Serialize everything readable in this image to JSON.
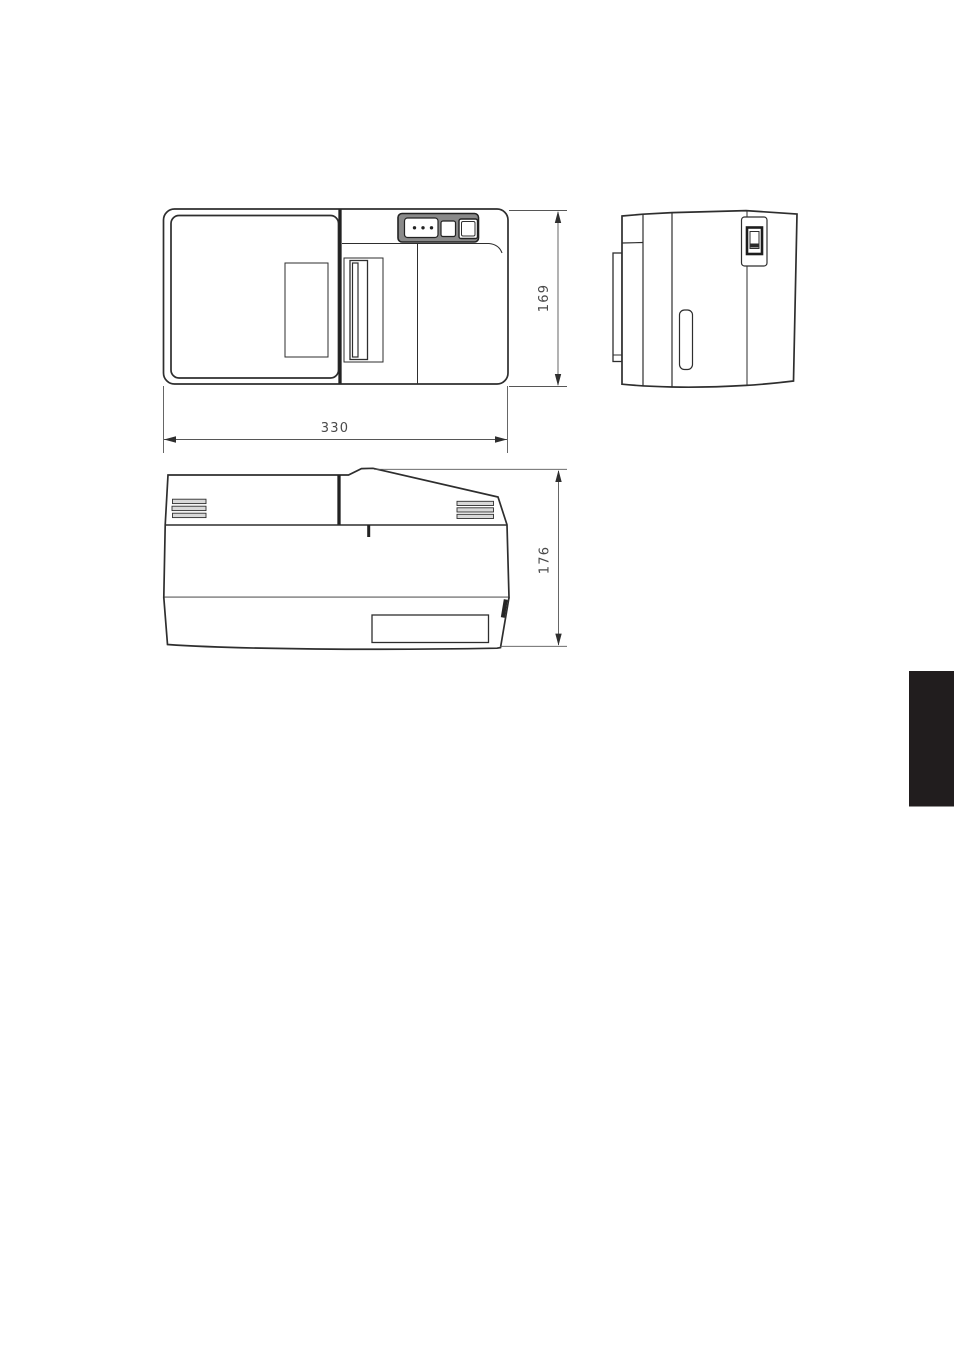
{
  "page": {
    "background": "#ffffff",
    "edge_tab_color": "#211d1e"
  },
  "drawing": {
    "stroke_color": "#2e2e2e",
    "dimension_line_color": "#565656",
    "dimension_text_color": "#4a4a4a",
    "control_panel_shade": "#8a8a8a",
    "vent_shade": "#d9d9d9",
    "views": {
      "top_view": "top-view",
      "side_view": "side-view",
      "front_view": "front-view"
    },
    "dimensions": {
      "width": "330",
      "depth": "169",
      "height": "176"
    }
  }
}
